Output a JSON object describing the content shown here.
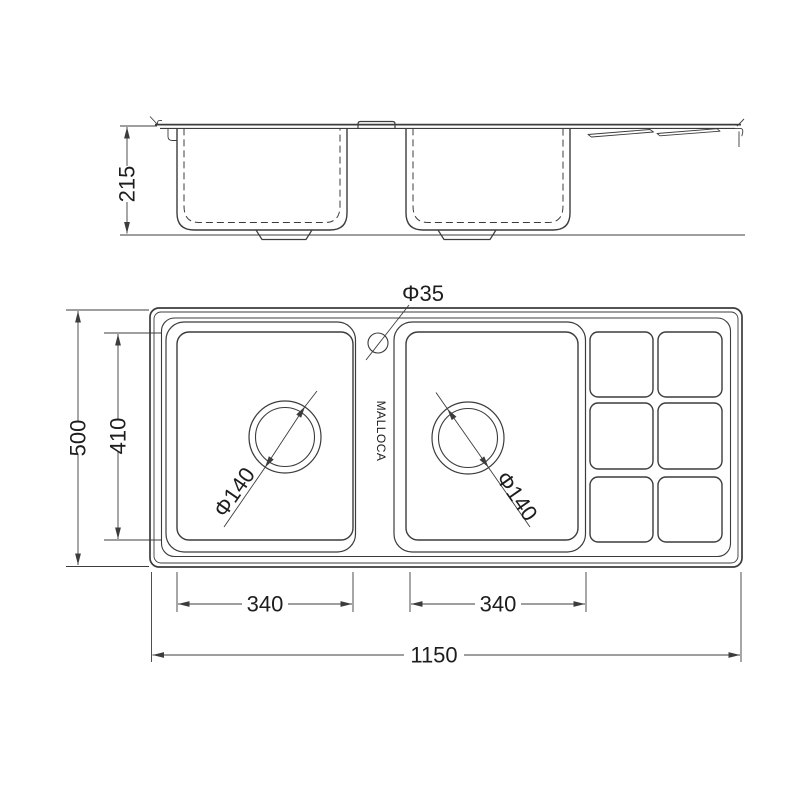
{
  "drawing": {
    "brand_text": "MALLOCA",
    "side_view": {
      "depth_dim": "215"
    },
    "plan_view": {
      "overall_length_dim": "1150",
      "overall_width_dim": "500",
      "bowl_inner_width_dim": "410",
      "left_bowl_length_dim": "340",
      "right_bowl_length_dim": "340",
      "faucet_hole_dim": "Φ35",
      "left_drain_dim": "Φ140",
      "right_drain_dim": "Φ140"
    }
  },
  "colors": {
    "line": "#3c3c3c",
    "text": "#1d1d1d",
    "background": "#ffffff"
  }
}
